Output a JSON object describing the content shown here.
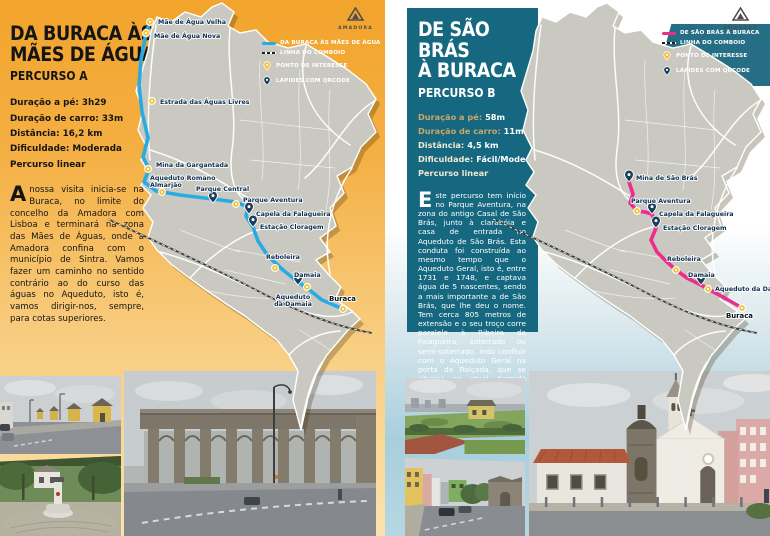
{
  "colors": {
    "accent_orange": "#F2A42C",
    "accent_teal": "#15687F",
    "route_blue": "#29ABE2",
    "route_pink": "#EC2D8C",
    "poi_yellow": "#F6C231",
    "qr_navy": "#1C3E5B"
  },
  "left": {
    "title1": "DA BURACA ÀS",
    "title2": "MÃES DE ÁGUA",
    "subtitle": "PERCURSO A",
    "logo": "AMADORA",
    "stats": [
      {
        "label": "Duração a pé:",
        "value": "3h29",
        "muted": false
      },
      {
        "label": "Duração de carro:",
        "value": "33m",
        "muted": false
      },
      {
        "label": "Distância:",
        "value": "16,2 km",
        "muted": false
      },
      {
        "label": "Dificuldade:",
        "value": "Moderada",
        "muted": false
      },
      {
        "label": "Percurso linear",
        "value": "",
        "muted": false
      }
    ],
    "body": {
      "dropcap": "A",
      "text": " nossa visita inicia-se na Buraca, no limite do concelho da Amadora com Lisboa e terminará na zona das Mães de Águas, onde a Amadora confina com o município de Sintra. Vamos fazer um caminho no sentido contrário ao do curso das águas no Aqueduto, isto é, vamos dirigir-nos, sempre, para cotas superiores."
    },
    "legend": [
      {
        "type": "route",
        "label": "DA BURACA ÀS MÃES DE ÁGUA"
      },
      {
        "type": "rail",
        "label": "LINHA DO COMBOIO"
      },
      {
        "type": "poi",
        "label": "PONTO DE INTERESSE"
      },
      {
        "type": "qr",
        "label": "LÁPIDES COM QRCODE"
      }
    ],
    "map": {
      "route_color": "#29ABE2",
      "route": [
        [
          150,
          22
        ],
        [
          146,
          33
        ],
        [
          141,
          60
        ],
        [
          139,
          85
        ],
        [
          142,
          112
        ],
        [
          148,
          138
        ],
        [
          143,
          157
        ],
        [
          149,
          169
        ],
        [
          144,
          182
        ],
        [
          156,
          191
        ],
        [
          180,
          195
        ],
        [
          213,
          199
        ],
        [
          236,
          202
        ],
        [
          248,
          207
        ],
        [
          246,
          216
        ],
        [
          253,
          227
        ],
        [
          258,
          241
        ],
        [
          268,
          256
        ],
        [
          283,
          270
        ],
        [
          298,
          282
        ],
        [
          307,
          288
        ],
        [
          322,
          300
        ],
        [
          343,
          309
        ]
      ],
      "points": [
        {
          "x": 150,
          "y": 22,
          "type": "poi",
          "label": "Mãe de Água Velha",
          "lx": 158,
          "ly": 24
        },
        {
          "x": 146,
          "y": 33,
          "type": "poi",
          "label": "Mãe de Água Nova",
          "lx": 154,
          "ly": 38
        },
        {
          "x": 152,
          "y": 101,
          "type": "poi",
          "label": "Estrada das Águas Livres",
          "lx": 160,
          "ly": 104
        },
        {
          "x": 148,
          "y": 169,
          "type": "poi",
          "label": "Mina da Gargantada",
          "lx": 156,
          "ly": 167
        },
        {
          "x": 162,
          "y": 192,
          "type": "poi",
          "label": "Aqueduto Romano\nAlmarjão",
          "lx": 150,
          "ly": 180
        },
        {
          "x": 213,
          "y": 203,
          "type": "qr",
          "label": "Parque Central",
          "lx": 196,
          "ly": 191
        },
        {
          "x": 236,
          "y": 204,
          "type": "poi",
          "label": "Parque Aventura",
          "lx": 243,
          "ly": 202
        },
        {
          "x": 249,
          "y": 214,
          "type": "qr",
          "label": "Capela da Falagueira",
          "lx": 256,
          "ly": 216
        },
        {
          "x": 253,
          "y": 227,
          "type": "qr",
          "label": "Estação Cloragem",
          "lx": 260,
          "ly": 229
        },
        {
          "x": 275,
          "y": 268,
          "type": "poi",
          "label": "Reboleira",
          "lx": 266,
          "ly": 259
        },
        {
          "x": 307,
          "y": 287,
          "type": "poi",
          "label": "Damaia",
          "lx": 294,
          "ly": 277
        },
        {
          "x": 298,
          "y": 285,
          "type": "qr",
          "label": "Aqueduto\nda Damaia",
          "lx": 293,
          "ly": 299,
          "anchor": "middle"
        },
        {
          "x": 343,
          "y": 309,
          "type": "poi",
          "label": "Buraca",
          "lx": 329,
          "ly": 301,
          "bold": true
        }
      ]
    }
  },
  "right": {
    "title1": "DE SÃO BRÁS",
    "title2": "À BURACA",
    "subtitle": "PERCURSO B",
    "logo": "AMADORA",
    "stats": [
      {
        "label": "Duração a pé:",
        "value": "58m",
        "muted": true
      },
      {
        "label": "Duração de carro:",
        "value": "11m",
        "muted": true
      },
      {
        "label": "Distância:",
        "value": "4,5 km",
        "muted": false
      },
      {
        "label": "Dificuldade:",
        "value": "Fácil/Moderada",
        "muted": false
      },
      {
        "label": "Percurso linear",
        "value": "",
        "muted": false
      }
    ],
    "body": {
      "dropcap": "E",
      "text": "ste percurso tem início no Parque Aventura, na zona do antigo Casal de São Brás, junto à clarabóia e casa de entrada no Aqueduto de São Brás. Esta conduta foi construída ao mesmo tempo que o Aqueduto Geral, isto é, entre 1731 e 1748, e captava água de 5 nascentes, sendo a mais importante a de São Brás, que lhe deu o nome. Tem cerca 805 metros de extensão e o seu troço corre paralelo à Ribeira da Falagueira, soterrado ou semi-soterrado, indo confluir com o Aqueduto Geral na porta da Roiçada, que se situava na atual Avenida General Humberto Delgado."
    },
    "legend": [
      {
        "type": "route",
        "label": "DE SÃO BRÁS À BURACA"
      },
      {
        "type": "rail",
        "label": "LINHA DO COMBOIO"
      },
      {
        "type": "poi",
        "label": "PONTO DE INTERESSE"
      },
      {
        "type": "qr",
        "label": "LÁPIDES COM QRCODE"
      }
    ],
    "map": {
      "route_color": "#EC2D8C",
      "route": [
        [
          244,
          182
        ],
        [
          248,
          194
        ],
        [
          245,
          203
        ],
        [
          252,
          211
        ],
        [
          260,
          212
        ],
        [
          267,
          214
        ],
        [
          271,
          228
        ],
        [
          266,
          240
        ],
        [
          272,
          252
        ],
        [
          282,
          262
        ],
        [
          291,
          270
        ],
        [
          302,
          278
        ],
        [
          316,
          285
        ],
        [
          323,
          289
        ],
        [
          338,
          297
        ],
        [
          357,
          308
        ]
      ],
      "points": [
        {
          "x": 244,
          "y": 182,
          "type": "qr",
          "label": "Mina de São Brás",
          "lx": 251,
          "ly": 180
        },
        {
          "x": 252,
          "y": 211,
          "type": "poi",
          "label": "Parque Aventura",
          "lx": 246,
          "ly": 203
        },
        {
          "x": 267,
          "y": 214,
          "type": "qr",
          "label": "Capela da Falagueira",
          "lx": 274,
          "ly": 216
        },
        {
          "x": 271,
          "y": 228,
          "type": "qr",
          "label": "Estação Cloragem",
          "lx": 278,
          "ly": 230
        },
        {
          "x": 291,
          "y": 270,
          "type": "poi",
          "label": "Reboleira",
          "lx": 282,
          "ly": 261
        },
        {
          "x": 316,
          "y": 285,
          "type": "qr",
          "label": "Damaia",
          "lx": 303,
          "ly": 277
        },
        {
          "x": 323,
          "y": 289,
          "type": "poi",
          "label": "Aqueduto da Damaia",
          "lx": 330,
          "ly": 291
        },
        {
          "x": 357,
          "y": 308,
          "type": "poi",
          "label": "Buraca",
          "lx": 341,
          "ly": 318,
          "bold": true
        }
      ]
    }
  }
}
